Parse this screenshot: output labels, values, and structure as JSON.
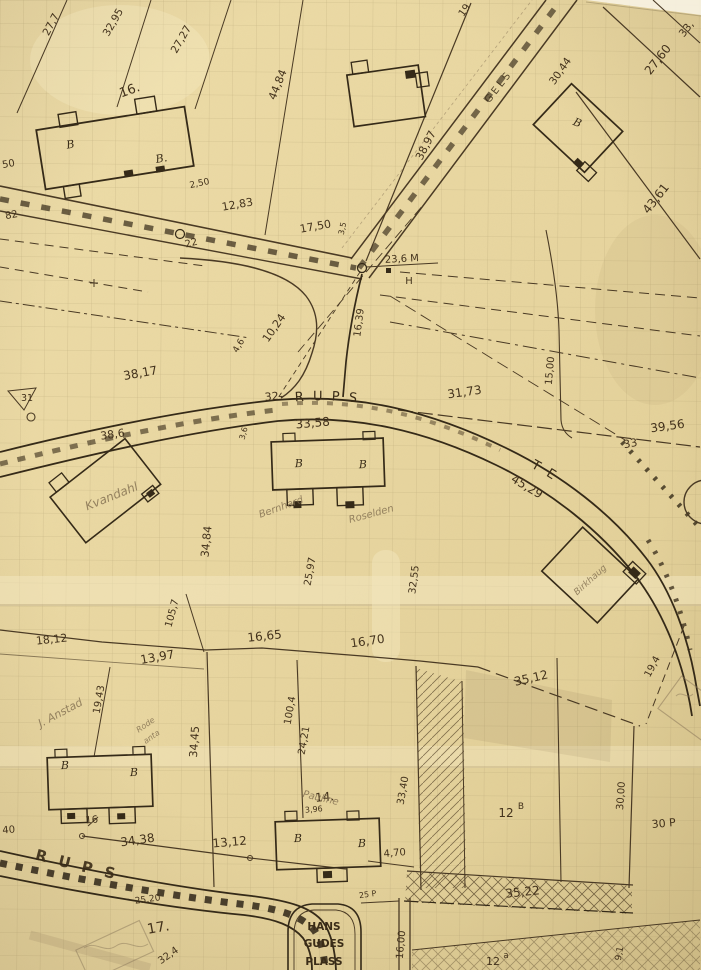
{
  "map": {
    "streets": {
      "hagerups_top": "HAGERUPS",
      "gate_top": "GATE",
      "riegels": "RIEGELS",
      "hagerups_bottom": "HAGERUPS",
      "hans_gudes": [
        "HANS",
        "GUDES",
        "PLASS"
      ]
    },
    "plots": {
      "p16": "16.",
      "p17": "17.",
      "p14": "14.",
      "p12_left": "12",
      "p12_left_sup": "B",
      "p12_bottom": "12",
      "p12_bottom_sup": "a"
    },
    "meas": [
      "27,7",
      "32,95",
      "27,27",
      "44,84",
      "19",
      "30,44",
      "33,",
      "27,60",
      "43,61",
      "38,97",
      "2,50",
      "12,83",
      "17,50",
      "3,5",
      "22",
      "82",
      "50",
      "23,6 M",
      "H",
      "16,39",
      "10,24",
      "4,6",
      "38,17",
      "31",
      "38,6",
      "32-",
      "33,58",
      "31,73",
      "15,00",
      "39,56",
      "33",
      "45,29",
      "3,6",
      "34,84",
      "25,97",
      "32,55",
      "105,7",
      "18,12",
      "13,97",
      "16,65",
      "16,70",
      "35,12",
      "19,4",
      "19,43",
      "34,45",
      "100,4",
      "24,21",
      "3,96",
      "16",
      "34,38",
      "13,12",
      "4,70",
      "33,40",
      "30,00",
      "30 P",
      "25 P",
      "35,22",
      "16,00",
      "25,20",
      "32,4",
      "40",
      "9,1"
    ],
    "building_labels": [
      "B",
      "B.",
      "B",
      "B",
      "B",
      "B",
      "B",
      "B",
      "B"
    ],
    "pencil_notes": [
      "Kvandahl",
      "Bernhard",
      "Roselden",
      "Birkhaug",
      "J. Anstad",
      "Rode",
      "anta",
      "Pauline"
    ],
    "colors": {
      "paper": "#e9d8a4",
      "ink": "#4a3a24",
      "dark_ink": "#352a18",
      "pencil": "#8a775a"
    }
  }
}
